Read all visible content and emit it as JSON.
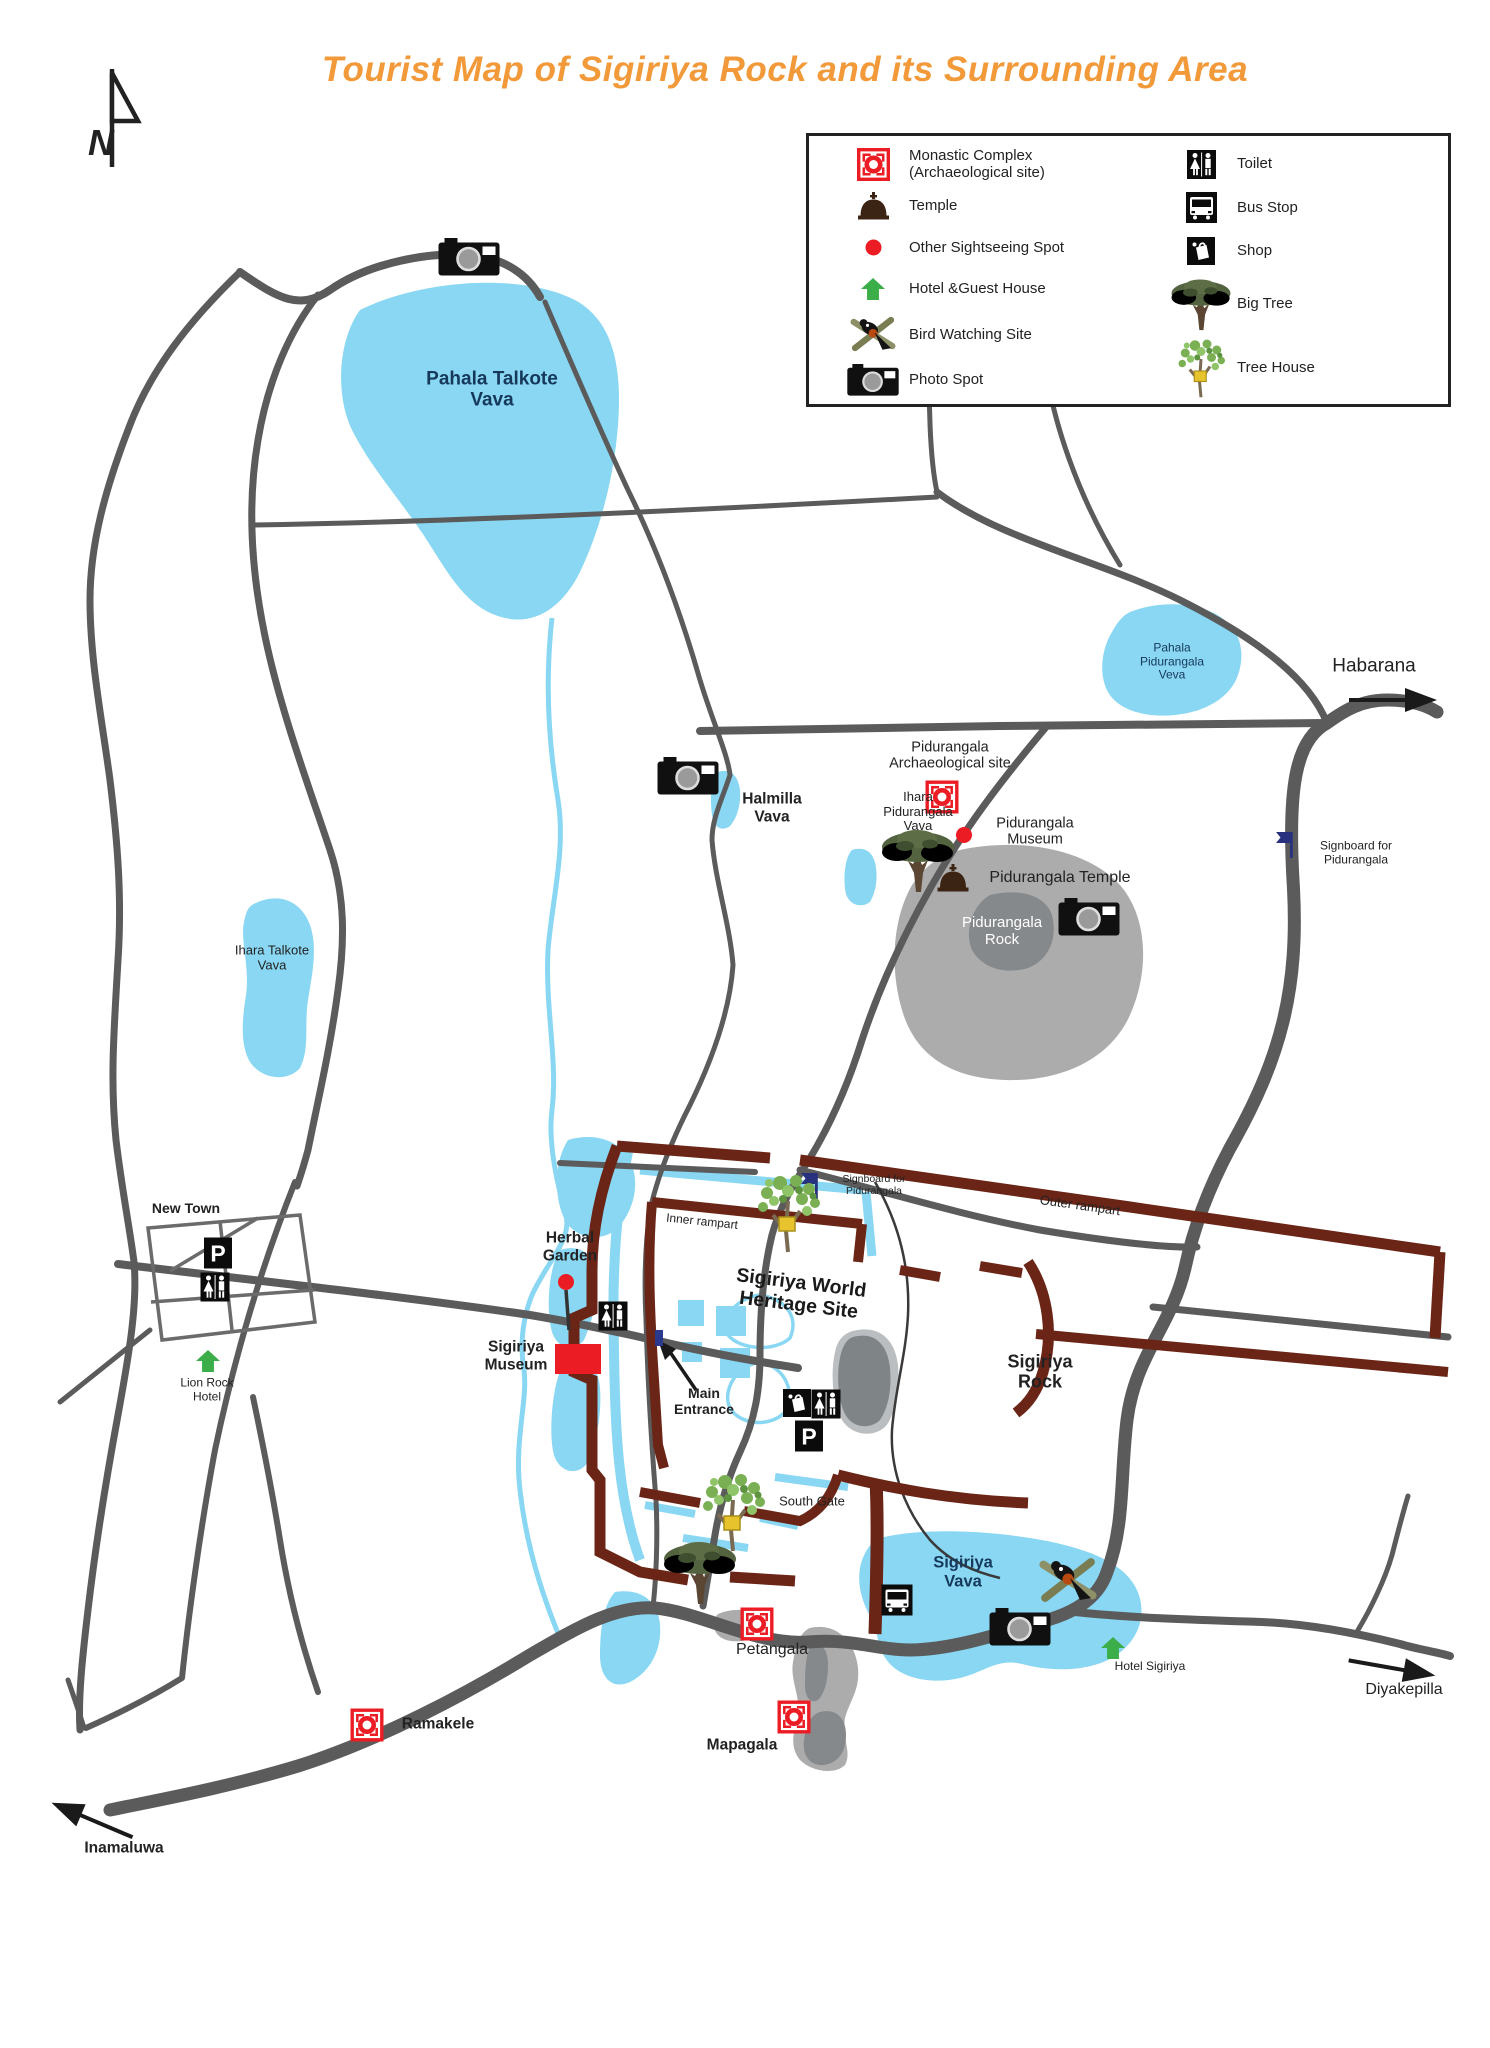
{
  "title": "Tourist Map of Sigiriya Rock and its Surrounding Area",
  "colors": {
    "title": "#F2993A",
    "water": "#89D7F3",
    "watertext": "#16395B",
    "road": "#5B5B5B",
    "rampart": "#6B2517",
    "rock": "#ACACAC",
    "rockdark": "#85898C",
    "red": "#EC1C24",
    "green": "#3BAE49",
    "navy": "#28317E",
    "ink": "#232323",
    "brown": "#3C2415"
  },
  "legend": {
    "left": [
      {
        "icon": "monastic-icon",
        "label": "Monastic Complex\n(Archaeological site)"
      },
      {
        "icon": "temple-icon",
        "label": "Temple"
      },
      {
        "icon": "sightseeing-dot-icon",
        "label": "Other Sightseeing Spot"
      },
      {
        "icon": "hotel-arrow-icon",
        "label": "Hotel &Guest House"
      },
      {
        "icon": "bird-watching-icon",
        "label": "Bird Watching Site"
      },
      {
        "icon": "camera-icon",
        "label": "Photo Spot"
      }
    ],
    "right": [
      {
        "icon": "toilet-icon",
        "label": "Toilet"
      },
      {
        "icon": "bus-stop-icon",
        "label": "Bus Stop"
      },
      {
        "icon": "shop-icon",
        "label": "Shop"
      },
      {
        "icon": "big-tree-icon",
        "label": "Big Tree"
      },
      {
        "icon": "tree-house-icon",
        "label": "Tree House"
      }
    ]
  },
  "places": [
    {
      "name": "pahala-talkote-vava",
      "text": "Pahala Talkote\nVava",
      "x": 492,
      "y": 390,
      "cls": "lake-lg"
    },
    {
      "name": "ihara-talkote-vava",
      "text": "Ihara Talkote\nVava",
      "x": 272,
      "y": 958,
      "cls": "plain-sm"
    },
    {
      "name": "halmilla-vava",
      "text": "Halmilla\nVava",
      "x": 772,
      "y": 808,
      "cls": "bold-md"
    },
    {
      "name": "ihara-pidurangala-vava",
      "text": "Ihara\nPidurangala\nVava",
      "x": 918,
      "y": 812,
      "cls": "plain-sm"
    },
    {
      "name": "pahala-pidurangala-veva",
      "text": "Pahala\nPidurangala\nVeva",
      "x": 1172,
      "y": 662,
      "cls": "lake-sm"
    },
    {
      "name": "habarana",
      "text": "Habarana",
      "x": 1374,
      "y": 666,
      "cls": "plain-lg"
    },
    {
      "name": "signboard-for-pidurangala-east",
      "text": "Signboard for\nPidurangala",
      "x": 1356,
      "y": 853,
      "cls": "plain-xs"
    },
    {
      "name": "pidurangala-archaeological-site",
      "text": "Pidurangala\nArchaeological site",
      "x": 950,
      "y": 756,
      "cls": "plain-md"
    },
    {
      "name": "pidurangala-museum",
      "text": "Pidurangala\nMuseum",
      "x": 1035,
      "y": 832,
      "cls": "plain-md"
    },
    {
      "name": "pidurangala-temple",
      "text": "Pidurangala Temple",
      "x": 1060,
      "y": 878,
      "cls": "plain-md2"
    },
    {
      "name": "pidurangala-rock",
      "text": "Pidurangala\nRock",
      "x": 1002,
      "y": 932,
      "cls": "white-md"
    },
    {
      "name": "new-town",
      "text": "New Town",
      "x": 186,
      "y": 1209,
      "cls": "bold-sm"
    },
    {
      "name": "lion-rock-hotel",
      "text": "Lion Rock\nHotel",
      "x": 207,
      "y": 1390,
      "cls": "plain-xs"
    },
    {
      "name": "herbal-garden",
      "text": "Herbal\nGarden",
      "x": 570,
      "y": 1247,
      "cls": "bold-md"
    },
    {
      "name": "sigiriya-museum",
      "text": "Sigiriya\nMuseum",
      "x": 516,
      "y": 1356,
      "cls": "bold-md"
    },
    {
      "name": "main-entrance",
      "text": "Main\nEntrance",
      "x": 704,
      "y": 1402,
      "cls": "bold-sm"
    },
    {
      "name": "inner-rampart",
      "text": "Inner rampart",
      "x": 702,
      "y": 1222,
      "cls": "plain-xs",
      "rot": 6
    },
    {
      "name": "outer-rampart",
      "text": "Outer rampart",
      "x": 1080,
      "y": 1206,
      "cls": "plain-sm",
      "rot": 8
    },
    {
      "name": "signboard-for-pidurangala-complex",
      "text": "Signboard for\nPidurangala",
      "x": 874,
      "y": 1186,
      "cls": "plain-xxs"
    },
    {
      "name": "sigiriya-world-heritage-site",
      "text": "Sigiriya World\nHeritage Site",
      "x": 800,
      "y": 1294,
      "cls": "title-lg",
      "rot": 7
    },
    {
      "name": "sigiriya-rock",
      "text": "Sigiriya\nRock",
      "x": 1040,
      "y": 1372,
      "cls": "bold-lg"
    },
    {
      "name": "south-gate",
      "text": "South Gate",
      "x": 812,
      "y": 1502,
      "cls": "plain-sm"
    },
    {
      "name": "sigiriya-vava",
      "text": "Sigiriya\nVava",
      "x": 963,
      "y": 1572,
      "cls": "lake-md"
    },
    {
      "name": "hotel-sigiriya",
      "text": "Hotel Sigiriya",
      "x": 1150,
      "y": 1667,
      "cls": "plain-xs"
    },
    {
      "name": "petangala",
      "text": "Petangala",
      "x": 772,
      "y": 1650,
      "cls": "plain-md2"
    },
    {
      "name": "mapagala",
      "text": "Mapagala",
      "x": 742,
      "y": 1745,
      "cls": "bold-md"
    },
    {
      "name": "ramakele",
      "text": "Ramakele",
      "x": 438,
      "y": 1724,
      "cls": "bold-md"
    },
    {
      "name": "inamaluwa",
      "text": "Inamaluwa",
      "x": 124,
      "y": 1848,
      "cls": "bold-md"
    },
    {
      "name": "diyakepilla",
      "text": "Diyakepilla",
      "x": 1404,
      "y": 1690,
      "cls": "plain-md2"
    }
  ],
  "markers": [
    {
      "t": "north",
      "x": 112,
      "y": 118,
      "n": "north-arrow-icon"
    },
    {
      "t": "camera",
      "x": 469,
      "y": 257,
      "n": "photo-spot-pahala-talkote-icon"
    },
    {
      "t": "camera",
      "x": 688,
      "y": 776,
      "n": "photo-spot-halmilla-icon"
    },
    {
      "t": "camera",
      "x": 1089,
      "y": 917,
      "n": "photo-spot-pidurangala-icon"
    },
    {
      "t": "camera",
      "x": 1020,
      "y": 1627,
      "n": "photo-spot-sigiriya-vava-icon"
    },
    {
      "t": "monastic",
      "x": 942,
      "y": 797,
      "n": "monastic-pidurangala-icon"
    },
    {
      "t": "monastic",
      "x": 757,
      "y": 1624,
      "n": "monastic-petangala-icon"
    },
    {
      "t": "monastic",
      "x": 794,
      "y": 1717,
      "n": "monastic-mapagala-icon"
    },
    {
      "t": "monastic",
      "x": 367,
      "y": 1725,
      "n": "monastic-ramakele-icon"
    },
    {
      "t": "temple",
      "x": 953,
      "y": 878,
      "n": "temple-pidurangala-icon"
    },
    {
      "t": "dot",
      "x": 964,
      "y": 835,
      "n": "sightseeing-pidurangala-museum-icon"
    },
    {
      "t": "dot",
      "x": 566,
      "y": 1282,
      "n": "sightseeing-herbal-garden-icon"
    },
    {
      "t": "hotel",
      "x": 208,
      "y": 1361,
      "n": "hotel-lion-rock-icon"
    },
    {
      "t": "hotel",
      "x": 1113,
      "y": 1648,
      "n": "hotel-sigiriya-icon"
    },
    {
      "t": "bird",
      "x": 1068,
      "y": 1580,
      "n": "bird-watching-site-icon"
    },
    {
      "t": "toilet",
      "x": 215,
      "y": 1287,
      "n": "toilet-new-town-icon"
    },
    {
      "t": "toilet",
      "x": 613,
      "y": 1316,
      "n": "toilet-west-gate-icon"
    },
    {
      "t": "toilet",
      "x": 826,
      "y": 1404,
      "n": "toilet-central-icon"
    },
    {
      "t": "parking",
      "x": 218,
      "y": 1253,
      "n": "parking-new-town-icon"
    },
    {
      "t": "parking",
      "x": 809,
      "y": 1436,
      "n": "parking-central-icon"
    },
    {
      "t": "shop",
      "x": 797,
      "y": 1403,
      "n": "shop-central-icon"
    },
    {
      "t": "bus",
      "x": 897,
      "y": 1600,
      "n": "bus-stop-sigiriya-icon"
    },
    {
      "t": "flag",
      "x": 1287,
      "y": 845,
      "n": "signboard-flag-east-icon"
    },
    {
      "t": "flag",
      "x": 812,
      "y": 1186,
      "n": "signboard-flag-complex-icon"
    },
    {
      "t": "bigtree",
      "x": 918,
      "y": 860,
      "n": "big-tree-ihara-pidurangala-icon"
    },
    {
      "t": "bigtree",
      "x": 700,
      "y": 1572,
      "n": "big-tree-southwest-icon"
    },
    {
      "t": "treehouse",
      "x": 788,
      "y": 1213,
      "n": "tree-house-north-gate-icon"
    },
    {
      "t": "treehouse",
      "x": 733,
      "y": 1512,
      "n": "tree-house-south-gate-icon"
    },
    {
      "t": "redrect",
      "x": 578,
      "y": 1359,
      "n": "sigiriya-museum-building-icon"
    },
    {
      "t": "bluedot",
      "x": 659,
      "y": 1338,
      "n": "main-entrance-gate-icon"
    },
    {
      "t": "dirarrow",
      "x": 1393,
      "y": 700,
      "rot": 0,
      "n": "arrow-to-habarana-icon"
    },
    {
      "t": "dirarrow",
      "x": 1392,
      "y": 1668,
      "rot": 10,
      "n": "arrow-to-diyakepilla-icon"
    },
    {
      "t": "dirarrow",
      "x": 92,
      "y": 1820,
      "rot": 203,
      "n": "arrow-to-inamaluwa-icon"
    }
  ]
}
